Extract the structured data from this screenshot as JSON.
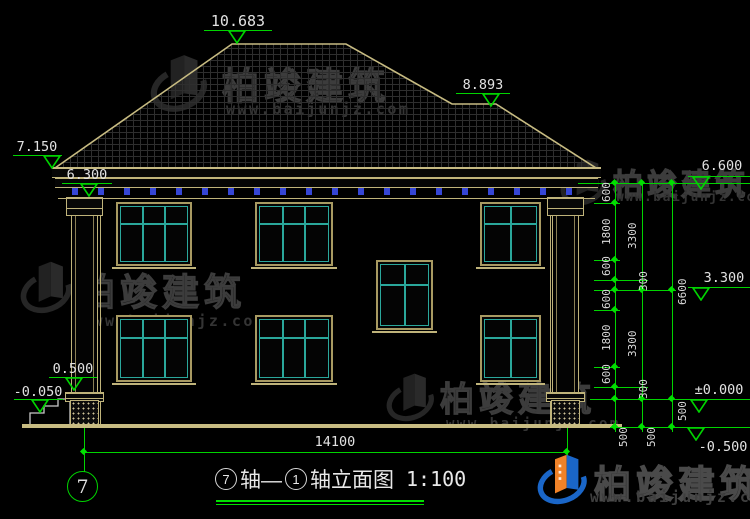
{
  "title": {
    "axis_start": "7",
    "axis_sep": "轴—",
    "axis_end": "1",
    "suffix": "轴立面图",
    "scale": "1:100"
  },
  "axis_bubble": {
    "label": "7"
  },
  "elevations": {
    "ridge": "10.683",
    "roof_break": "8.893",
    "eave_left_top": "7.150",
    "eave_left_bottom": "6.300",
    "right_eave": "6.600",
    "right_floor2": "3.300",
    "right_zero": "±0.000",
    "right_ground": "-0.500",
    "left_porch": "0.500",
    "left_ground": "-0.050"
  },
  "dimensions": {
    "chain1": [
      "600",
      "1800",
      "600",
      "300",
      "600",
      "1800",
      "600",
      "300",
      "500"
    ],
    "chain2": [
      "3300",
      "3300",
      "500"
    ],
    "chain3": [
      "6600",
      "500"
    ],
    "total_width": "14100"
  },
  "watermark": {
    "name": "柏竣建筑",
    "url": "www.baijunjz.com"
  },
  "colors": {
    "line_green": "#00d400",
    "cad_tan": "#bfb37a",
    "window_teal": "#2aa79b",
    "dentil_blue": "#3546d6",
    "text_white": "#e2e2e2",
    "logo_blue": "#1a66c8",
    "logo_orange": "#f08228"
  }
}
